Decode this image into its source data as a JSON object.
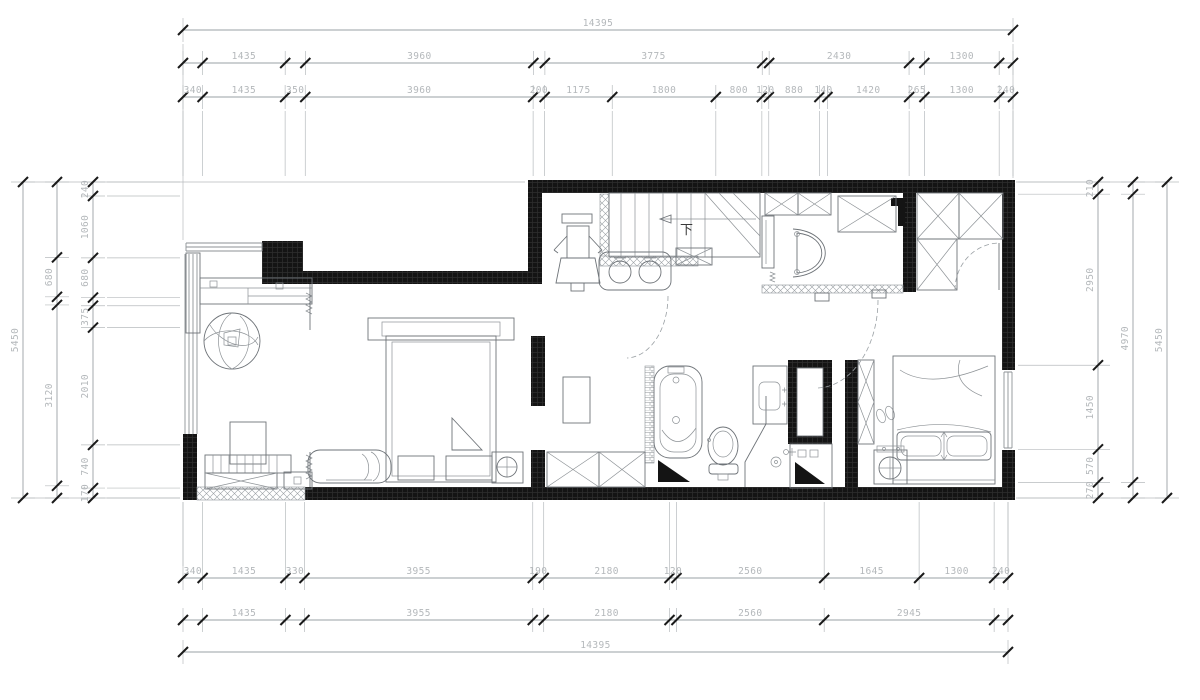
{
  "colors": {
    "wall": "#141414",
    "dim_line": "#9aa0a4",
    "dim_text": "#b4b8bb",
    "tick": "#1a1a1a",
    "furniture": "#6e7378",
    "background": "#ffffff"
  },
  "plan": {
    "stair_down_label": "下"
  },
  "dimensions": {
    "unit": "mm",
    "rows": [
      {
        "name": "top-overall",
        "segments": [
          {
            "len": 14395,
            "label": "14395"
          }
        ]
      },
      {
        "name": "top-row-2",
        "segments": [
          {
            "len": 340
          },
          {
            "len": 1435,
            "label": "1435"
          },
          {
            "len": 350
          },
          {
            "len": 3960,
            "label": "3960"
          },
          {
            "len": 200
          },
          {
            "len": 3775,
            "label": "3775"
          },
          {
            "len": 120
          },
          {
            "len": 2430,
            "label": "2430"
          },
          {
            "len": 265
          },
          {
            "len": 1300,
            "label": "1300"
          },
          {
            "len": 240
          }
        ]
      },
      {
        "name": "top-row-3",
        "segments": [
          {
            "len": 340,
            "label": "340"
          },
          {
            "len": 1435,
            "label": "1435"
          },
          {
            "len": 350,
            "label": "350"
          },
          {
            "len": 3960,
            "label": "3960"
          },
          {
            "len": 200,
            "label": "200"
          },
          {
            "len": 1175,
            "label": "1175"
          },
          {
            "len": 1800,
            "label": "1800"
          },
          {
            "len": 800,
            "label": "800"
          },
          {
            "len": 120,
            "label": "120"
          },
          {
            "len": 880,
            "label": "880"
          },
          {
            "len": 140,
            "label": "140"
          },
          {
            "len": 1420,
            "label": "1420"
          },
          {
            "len": 265,
            "label": "265"
          },
          {
            "len": 1300,
            "label": "1300"
          },
          {
            "len": 240,
            "label": "240"
          }
        ]
      },
      {
        "name": "bottom-row-1",
        "segments": [
          {
            "len": 340,
            "label": "340"
          },
          {
            "len": 1435,
            "label": "1435"
          },
          {
            "len": 330,
            "label": "330"
          },
          {
            "len": 3955,
            "label": "3955"
          },
          {
            "len": 190,
            "label": "190"
          },
          {
            "len": 2180,
            "label": "2180"
          },
          {
            "len": 120,
            "label": "120"
          },
          {
            "len": 2560,
            "label": "2560"
          },
          {
            "len": 1645,
            "label": "1645"
          },
          {
            "len": 1300,
            "label": "1300"
          },
          {
            "len": 240,
            "label": "240"
          }
        ]
      },
      {
        "name": "bottom-row-2",
        "segments": [
          {
            "len": 340
          },
          {
            "len": 1435,
            "label": "1435"
          },
          {
            "len": 330
          },
          {
            "len": 3955,
            "label": "3955"
          },
          {
            "len": 190
          },
          {
            "len": 2180,
            "label": "2180"
          },
          {
            "len": 120
          },
          {
            "len": 2560,
            "label": "2560"
          },
          {
            "len": 2945,
            "label": "2945"
          },
          {
            "len": 240
          }
        ]
      },
      {
        "name": "bottom-overall",
        "segments": [
          {
            "len": 14395,
            "label": "14395"
          }
        ]
      },
      {
        "name": "left-col-inner",
        "segments": [
          {
            "len": 240,
            "label": "240"
          },
          {
            "len": 1060,
            "label": "1060"
          },
          {
            "len": 680,
            "label": "680"
          },
          {
            "len": 140
          },
          {
            "len": 375,
            "label": "375"
          },
          {
            "len": 2010,
            "label": "2010"
          },
          {
            "len": 740,
            "label": "740"
          },
          {
            "len": 170,
            "label": "170"
          }
        ]
      },
      {
        "name": "left-col-mid",
        "segments": [
          {
            "len": 1300
          },
          {
            "len": 680,
            "label": "680"
          },
          {
            "len": 140
          },
          {
            "len": 3120,
            "label": "3120"
          },
          {
            "len": 210
          }
        ]
      },
      {
        "name": "left-overall",
        "segments": [
          {
            "len": 5450,
            "label": "5450"
          }
        ]
      },
      {
        "name": "right-col-inner",
        "segments": [
          {
            "len": 210,
            "label": "210"
          },
          {
            "len": 2950,
            "label": "2950"
          },
          {
            "len": 1450,
            "label": "1450"
          },
          {
            "len": 570,
            "label": "570"
          },
          {
            "len": 270,
            "label": "270"
          }
        ]
      },
      {
        "name": "right-col-mid",
        "segments": [
          {
            "len": 210
          },
          {
            "len": 4970,
            "label": "4970"
          },
          {
            "len": 270
          }
        ]
      },
      {
        "name": "right-overall",
        "segments": [
          {
            "len": 5450,
            "label": "5450"
          }
        ]
      }
    ]
  }
}
